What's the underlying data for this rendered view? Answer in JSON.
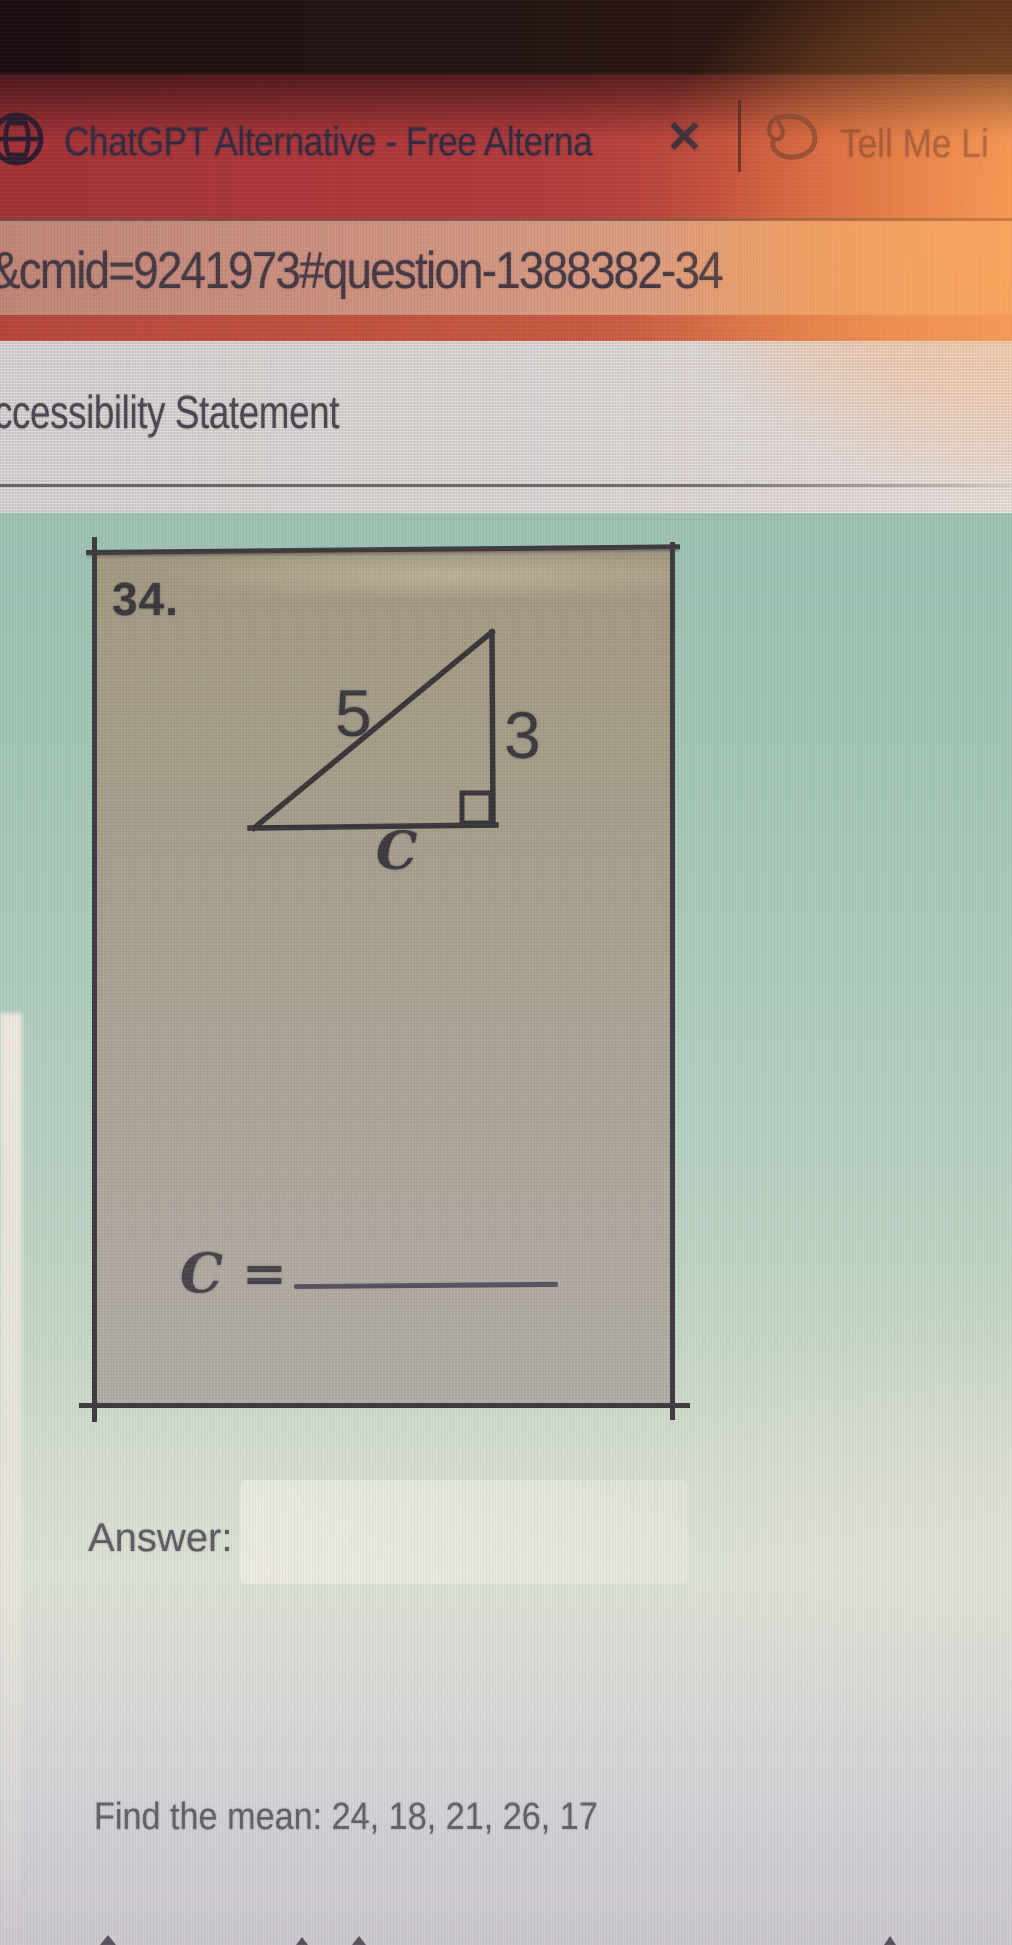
{
  "browser": {
    "tab_bar": {
      "active_tab": {
        "title": "ChatGPT Alternative - Free Alterna",
        "close_glyph": "✕",
        "favicon_icon": "globe-favicon-icon"
      },
      "second_tab": {
        "title": "Tell Me Li",
        "favicon_icon": "disney-d-icon"
      }
    },
    "url_bar": {
      "value": "&cmid=9241973#question-1388382-34"
    }
  },
  "page": {
    "accessibility_link": "ccessibility Statement",
    "question_card": {
      "number": "34.",
      "triangle": {
        "hypotenuse_label": "5",
        "vertical_label": "3",
        "base_label": "C"
      },
      "fill_in": {
        "prompt": "C ="
      }
    },
    "answer": {
      "label": "Answer:",
      "value": ""
    },
    "next_question": {
      "text": "Find the mean: 24, 18, 21, 26, 17"
    }
  },
  "colors": {
    "tab_bar_red": "#b13a3b",
    "glare_orange": "#f09a5c",
    "url_strip_pink": "#d59a82",
    "content_teal": "#a3c6b7",
    "card_tan": "#a9a18c",
    "ink_dark": "#3e3a3e"
  }
}
